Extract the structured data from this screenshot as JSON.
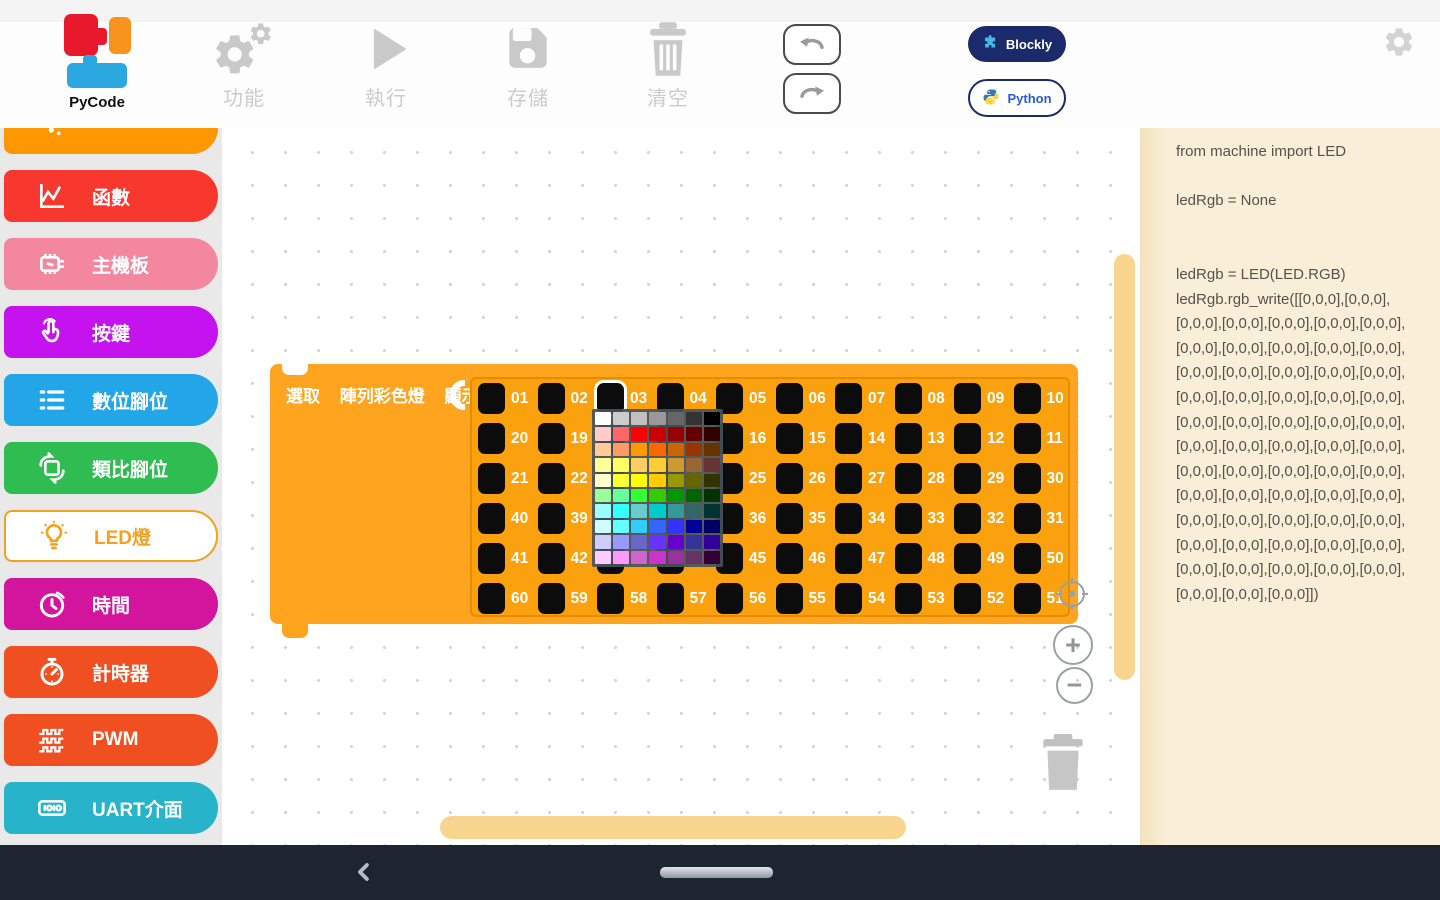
{
  "toolbar": {
    "logo_label": "PyCode",
    "buttons": [
      {
        "id": "features",
        "label": "功能",
        "icon": "gear-double-icon"
      },
      {
        "id": "run",
        "label": "執行",
        "icon": "play-icon"
      },
      {
        "id": "save",
        "label": "存儲",
        "icon": "floppy-icon"
      },
      {
        "id": "clear",
        "label": "清空",
        "icon": "trash-icon"
      }
    ],
    "mode_buttons": [
      {
        "id": "blockly",
        "label": "Blockly",
        "active": true
      },
      {
        "id": "python",
        "label": "Python",
        "active": false
      }
    ],
    "colors": {
      "blockly_bg": "#1b2a6b",
      "python_text": "#2a5bd7",
      "icon_gray": "#c9c9c9"
    }
  },
  "sidebar": {
    "items": [
      {
        "id": "variables",
        "label": "",
        "icon": "dots",
        "bg": "#ff9800",
        "cut_top": true
      },
      {
        "id": "functions",
        "label": "函數",
        "icon": "chart",
        "bg": "#f8372f"
      },
      {
        "id": "mainboard",
        "label": "主機板",
        "icon": "board",
        "bg": "#f2879f"
      },
      {
        "id": "buttons",
        "label": "按鍵",
        "icon": "touch",
        "bg": "#c413ef"
      },
      {
        "id": "digital-pin",
        "label": "數位腳位",
        "icon": "list",
        "bg": "#23a6e8"
      },
      {
        "id": "analog-pin",
        "label": "類比腳位",
        "icon": "cycle",
        "bg": "#2fbd52"
      },
      {
        "id": "led",
        "label": "LED燈",
        "icon": "bulb",
        "bg": "#ffffff",
        "fg": "#f5a11c",
        "border": "#f0a11e",
        "selected": true
      },
      {
        "id": "time",
        "label": "時間",
        "icon": "clock",
        "bg": "#d3149c"
      },
      {
        "id": "timer",
        "label": "計時器",
        "icon": "stopwatch",
        "bg": "#f04f21"
      },
      {
        "id": "pwm",
        "label": "PWM",
        "icon": "pwm",
        "bg": "#f04f21"
      },
      {
        "id": "uart",
        "label": "UART介面",
        "icon": "uart",
        "bg": "#27b4ca"
      }
    ]
  },
  "canvas": {
    "block": {
      "header_parts": [
        "選取",
        "陣列彩色燈",
        "顯示"
      ],
      "selected_led": "03",
      "grid_rows": [
        [
          "01",
          "02",
          "03",
          "04",
          "05",
          "06",
          "07",
          "08",
          "09",
          "10"
        ],
        [
          "20",
          "19",
          "18",
          "17",
          "16",
          "15",
          "14",
          "13",
          "12",
          "11"
        ],
        [
          "21",
          "22",
          "23",
          "24",
          "25",
          "26",
          "27",
          "28",
          "29",
          "30"
        ],
        [
          "40",
          "39",
          "38",
          "37",
          "36",
          "35",
          "34",
          "33",
          "32",
          "31"
        ],
        [
          "41",
          "42",
          "43",
          "44",
          "45",
          "46",
          "47",
          "48",
          "49",
          "50"
        ],
        [
          "60",
          "59",
          "58",
          "57",
          "56",
          "55",
          "54",
          "53",
          "52",
          "51"
        ]
      ],
      "colors": {
        "block_bg": "#ffa41e",
        "panel_bg": "#fca10e",
        "panel_border": "#e68c00",
        "led_bg": "#0c0c0c",
        "label": "#ffffff"
      }
    },
    "color_picker": {
      "columns": 7,
      "colors": [
        "#ffffff",
        "#cccccc",
        "#c0c0c0",
        "#999999",
        "#666666",
        "#333333",
        "#000000",
        "#ffcccc",
        "#ff6666",
        "#ff0000",
        "#cc0000",
        "#990000",
        "#660000",
        "#330000",
        "#ffcc99",
        "#ff9966",
        "#ff9900",
        "#ff6600",
        "#cc6600",
        "#993300",
        "#663300",
        "#ffff99",
        "#ffff66",
        "#ffcc66",
        "#ffcc33",
        "#cc9933",
        "#996633",
        "#663333",
        "#ffffcc",
        "#ffff33",
        "#ffff00",
        "#ffcc00",
        "#999900",
        "#666600",
        "#333300",
        "#99ff99",
        "#66ff99",
        "#33ff33",
        "#33cc00",
        "#009900",
        "#006600",
        "#003300",
        "#99ffff",
        "#33ffff",
        "#66cccc",
        "#00cccc",
        "#339999",
        "#336666",
        "#003333",
        "#ccffff",
        "#66ffff",
        "#33ccff",
        "#3366ff",
        "#3333ff",
        "#000099",
        "#000066",
        "#ccccff",
        "#9999ff",
        "#6666cc",
        "#6633ff",
        "#6600cc",
        "#333399",
        "#330099",
        "#ffccff",
        "#ff99ff",
        "#cc66cc",
        "#cc33cc",
        "#993399",
        "#663366",
        "#330033"
      ]
    },
    "controls": {
      "zoom_in_label": "+",
      "zoom_out_label": "−"
    },
    "scrollbar_color": "#f8d58e"
  },
  "code_panel": {
    "bg": "#f9efd9",
    "text_color": "#55524a",
    "lines": [
      "from machine import LED",
      "",
      "ledRgb = None",
      "",
      "",
      "ledRgb = LED(LED.RGB)",
      "ledRgb.rgb_write([[0,0,0],[0,0,0],",
      "[0,0,0],[0,0,0],[0,0,0],[0,0,0],[0,0,0],",
      "[0,0,0],[0,0,0],[0,0,0],[0,0,0],[0,0,0],",
      "[0,0,0],[0,0,0],[0,0,0],[0,0,0],[0,0,0],",
      "[0,0,0],[0,0,0],[0,0,0],[0,0,0],[0,0,0],",
      "[0,0,0],[0,0,0],[0,0,0],[0,0,0],[0,0,0],",
      "[0,0,0],[0,0,0],[0,0,0],[0,0,0],[0,0,0],",
      "[0,0,0],[0,0,0],[0,0,0],[0,0,0],[0,0,0],",
      "[0,0,0],[0,0,0],[0,0,0],[0,0,0],[0,0,0],",
      "[0,0,0],[0,0,0],[0,0,0],[0,0,0],[0,0,0],",
      "[0,0,0],[0,0,0],[0,0,0],[0,0,0],[0,0,0],",
      "[0,0,0],[0,0,0],[0,0,0],[0,0,0],[0,0,0],",
      "[0,0,0],[0,0,0],[0,0,0]])"
    ]
  },
  "nav_bar": {
    "bg": "#1d2530"
  }
}
